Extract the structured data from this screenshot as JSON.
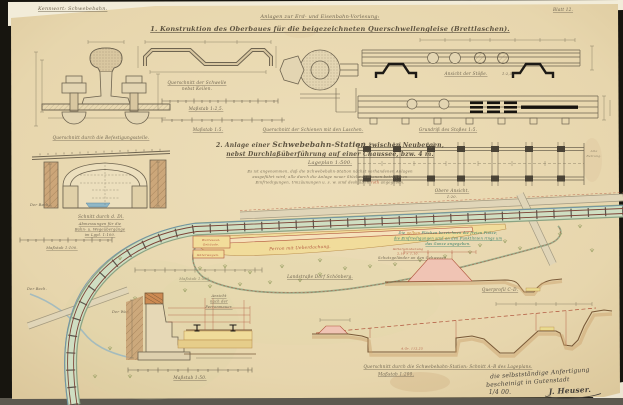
{
  "colors": {
    "paper": "#e9d9b2",
    "red_accent": "#b0543c",
    "teal_note": "#2f7b68",
    "yellow_station": "#f2dd9a",
    "green_band": "#cfdec2"
  },
  "header": {
    "left": "Kennwort: Schwebebahn.",
    "center": "Anlagen zur Erd- und Eisenbahn-Vorlesung:",
    "sheet_no": "Blatt 12."
  },
  "s1": {
    "title": "1. Konstruktion des Oberbaues für die beigezeichneten Querschwellengleise (Brettlaschen).",
    "befestigung": "Querschnitt durch die Befestigungsstelle.",
    "schwelle1": "Querschnitt der Schwelle",
    "schwelle2": "nebst Keilen.",
    "msb25": "Maßstab 1:2,5.",
    "msb5": "Maßstab 1:5.",
    "laschen": "Querschnitt der Schienen mit den Laschen.",
    "ansicht_stoss": "Ansicht der Stöße.",
    "stoss_scale": "1:2,5.",
    "grundriss": "Grundriß des Stoßes 1:5.",
    "obere1": "Obere Ansicht.",
    "obere2": "1:20.",
    "alte1": "Alte",
    "alte2": "Bettung."
  },
  "s2": {
    "t_pre": "2. Anlage einer ",
    "t_main": "Schwebebahn-Station",
    "t_post": " zwischen Neubergen,",
    "t_line2": "nebst Durchlaßüberführung auf einer Chaussee, bzw. 4 m.",
    "t_line3": "Lageplan 1:500.",
    "p1": "Es ist angenommen, daß die Schwebebahn-Station nächst vorhandenen Anlagen",
    "p2": "ausgeführt wird; alle durch die Anlage neuer Stücke-Stationen betroffenen",
    "p3a": "Einfriedigungen, Umzäunungen u. s. w. sind deshalb in ",
    "p3b": "roth",
    "p3c": " angegeben."
  },
  "culvert": {
    "caption": "Schnitt durch d. Dl.",
    "bach": "Der Bach."
  },
  "left_labels": {
    "ab1": "Abmessungen für die",
    "ab2": "Bahn- u. Wegeübergänge",
    "ab3": "im Lgpl. 1:100.",
    "msb100": "Maßstab 1:100.",
    "msb500": "Maßstab 1:500.",
    "bach2": "Der Bach.",
    "weg": "Der Weg."
  },
  "plan": {
    "perron": "Perron mit Ueberdachung.",
    "warte1": "Wartesaal-",
    "warte2": "Gebäude.",
    "gueter": "Güterwagen.",
    "strasse": "Landstraße Dorf Schönberg.",
    "teal1a": "Die ",
    "teal1b": "gelben",
    "teal1c": " Flächen bezeichnen die freien Plätze;",
    "teal2": "die Einfriedigungen sind an den Punktlinien rings um",
    "teal3": "das Ganze angegeben.",
    "red1": "Gitterumzäunung",
    "red2": "2,10 × 1,10.",
    "fence": "Schutzgeländer an den Gehwegen."
  },
  "profiles": {
    "querprofil": "Querprofil C–D.",
    "agr": "A.Gr. 112,25",
    "ab_caption": "Querschnitt durch die Schwebebahn-Station: Schnitt A–B des Lageplans.",
    "msb200": "Maßstab 1:200."
  },
  "wall": {
    "c1": "Ansicht",
    "c2": "nach der",
    "c3": "Perronmauer.",
    "msb50": "Maßstab 1:50."
  },
  "sig": {
    "l1": "die selbstständige Anfertigung",
    "l2": "bescheinigt in Gutenstadt",
    "date": "1/4 00.",
    "name": "J. Heuser."
  }
}
